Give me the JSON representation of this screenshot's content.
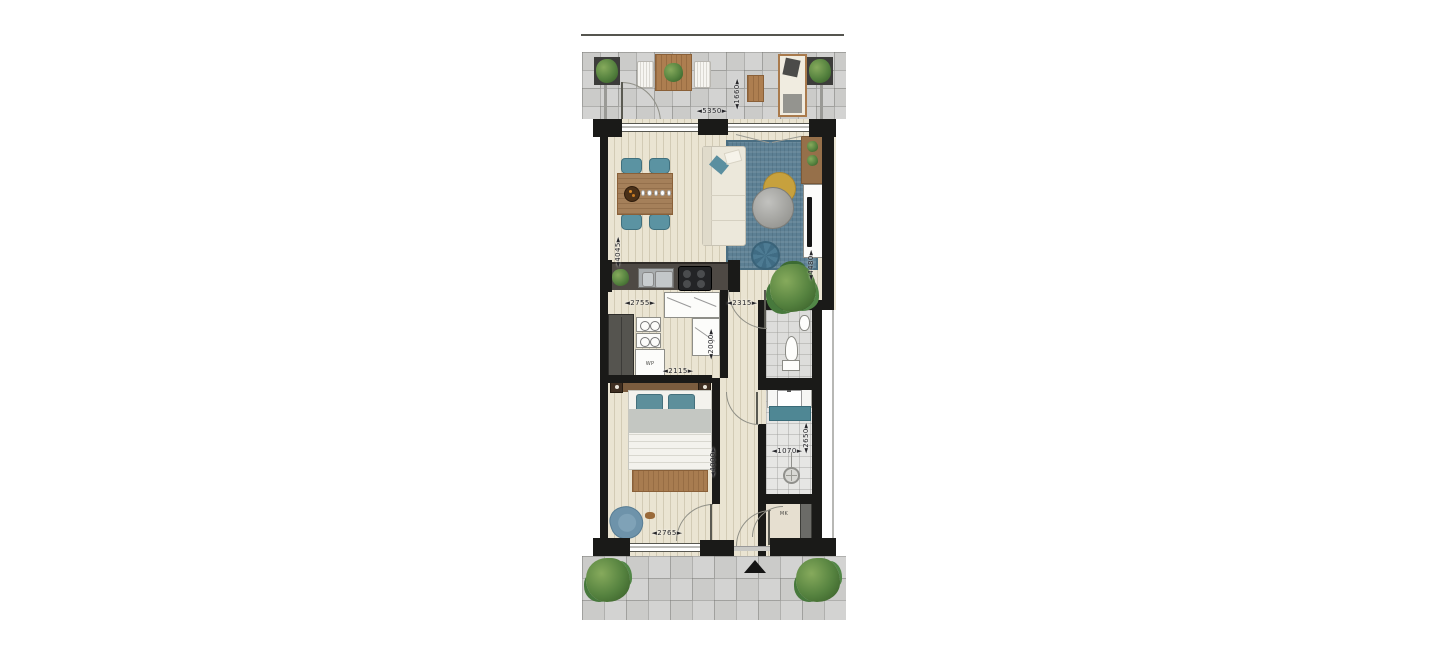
{
  "floorplan": {
    "type": "apartment-floor-plan",
    "dimensions": {
      "balcony_width": "◄5350►",
      "balcony_depth": "◄1660►",
      "living_depth_left": "◄4045►",
      "living_depth_right": "◄4480►",
      "kitchen_counter_width": "◄2755►",
      "entry_zone_width": "◄2315►",
      "kitchen_depth": "◄2000►",
      "kitchen_room_width": "◄2115►",
      "bedroom_depth": "◄4000►",
      "bathroom_width": "◄1070►",
      "bathroom_depth": "◄2650►",
      "bedroom_width": "◄2765►"
    },
    "room_labels": {
      "heat_pump": "WP",
      "meter_closet": "MK"
    },
    "icons": {
      "entrance_marker": "black-triangle-up",
      "door_swing": "quarter-circle-arc",
      "plants": "green-foliage-blobs"
    },
    "colors": {
      "wall": "#1a1a18",
      "wood_floor": "#eae4d2",
      "tile_floor": "#cbcbc9",
      "bathroom_tile": "#e6e6e4",
      "accent_teal": "#5b93a2",
      "rug_blue": "#5d8094",
      "furniture_wood": "#ad7e50",
      "plant_green": "#55823f",
      "mustard_accent": "#c7a13d"
    }
  }
}
